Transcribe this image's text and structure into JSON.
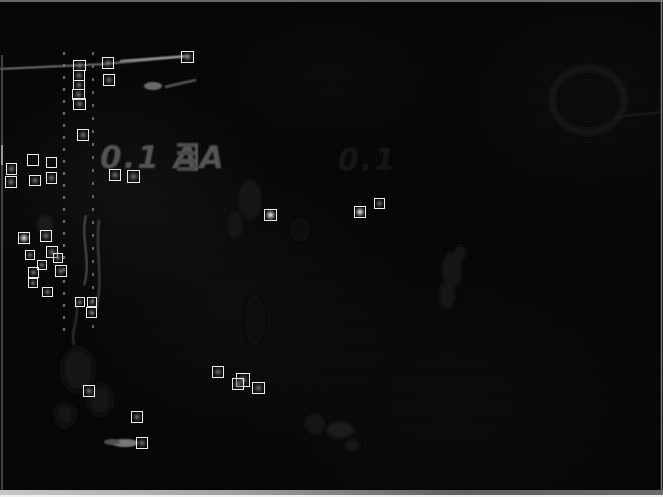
{
  "scene": {
    "description": "Dark grayscale processed night image (edge/difference map) of a vehicle-side scene with ladder poles, a cable line, faint truck marking and bushes",
    "background_color": "#050505",
    "marking_primary": "0.1 AA",
    "marking_secondary": "0.1",
    "frame": {
      "top_color": "#8a8a8a",
      "right_color": "#7a7a7a",
      "left_color": "#5a5a5a",
      "bottom_bar_left": "#c6c6c6",
      "bottom_bar_right": "#6a6a6a",
      "bottom_edge": "#f2f2f2"
    }
  },
  "overlay": {
    "box_color": "#eeeeee",
    "detections": [
      {
        "x": 73,
        "y": 60,
        "w": 13,
        "h": 11,
        "content": "dim"
      },
      {
        "x": 73,
        "y": 70,
        "w": 12,
        "h": 11,
        "content": "dim"
      },
      {
        "x": 73,
        "y": 80,
        "w": 12,
        "h": 10,
        "content": "dim"
      },
      {
        "x": 72,
        "y": 89,
        "w": 13,
        "h": 11,
        "content": "dim"
      },
      {
        "x": 73,
        "y": 98,
        "w": 13,
        "h": 12,
        "content": "dim"
      },
      {
        "x": 102,
        "y": 57,
        "w": 12,
        "h": 12,
        "content": "dim"
      },
      {
        "x": 103,
        "y": 74,
        "w": 12,
        "h": 12,
        "content": "dim"
      },
      {
        "x": 181,
        "y": 51,
        "w": 13,
        "h": 12,
        "content": "dim"
      },
      {
        "x": 77,
        "y": 129,
        "w": 12,
        "h": 12,
        "content": "dim"
      },
      {
        "x": 6,
        "y": 163,
        "w": 11,
        "h": 12,
        "content": "dim"
      },
      {
        "x": 5,
        "y": 176,
        "w": 12,
        "h": 12,
        "content": "dim"
      },
      {
        "x": 27,
        "y": 154,
        "w": 12,
        "h": 12,
        "content": "none"
      },
      {
        "x": 29,
        "y": 175,
        "w": 12,
        "h": 11,
        "content": "dim"
      },
      {
        "x": 46,
        "y": 157,
        "w": 11,
        "h": 11,
        "content": "none"
      },
      {
        "x": 46,
        "y": 172,
        "w": 11,
        "h": 12,
        "content": "dim"
      },
      {
        "x": 109,
        "y": 169,
        "w": 12,
        "h": 12,
        "content": "dim"
      },
      {
        "x": 127,
        "y": 170,
        "w": 13,
        "h": 13,
        "content": "dim"
      },
      {
        "x": 18,
        "y": 232,
        "w": 12,
        "h": 12,
        "content": "bright"
      },
      {
        "x": 40,
        "y": 230,
        "w": 12,
        "h": 12,
        "content": "dim"
      },
      {
        "x": 25,
        "y": 250,
        "w": 10,
        "h": 10,
        "content": "dim"
      },
      {
        "x": 46,
        "y": 246,
        "w": 12,
        "h": 12,
        "content": "dim"
      },
      {
        "x": 37,
        "y": 260,
        "w": 10,
        "h": 10,
        "content": "dim"
      },
      {
        "x": 53,
        "y": 253,
        "w": 10,
        "h": 10,
        "content": "dim"
      },
      {
        "x": 28,
        "y": 267,
        "w": 11,
        "h": 11,
        "content": "dim"
      },
      {
        "x": 55,
        "y": 265,
        "w": 12,
        "h": 12,
        "content": "dim"
      },
      {
        "x": 28,
        "y": 278,
        "w": 10,
        "h": 10,
        "content": "dim"
      },
      {
        "x": 42,
        "y": 287,
        "w": 11,
        "h": 10,
        "content": "dim"
      },
      {
        "x": 75,
        "y": 297,
        "w": 10,
        "h": 10,
        "content": "dim"
      },
      {
        "x": 87,
        "y": 297,
        "w": 10,
        "h": 10,
        "content": "dim"
      },
      {
        "x": 86,
        "y": 307,
        "w": 11,
        "h": 11,
        "content": "dim"
      },
      {
        "x": 264,
        "y": 209,
        "w": 13,
        "h": 12,
        "content": "bright"
      },
      {
        "x": 354,
        "y": 206,
        "w": 12,
        "h": 12,
        "content": "bright"
      },
      {
        "x": 374,
        "y": 198,
        "w": 11,
        "h": 11,
        "content": "dim"
      },
      {
        "x": 212,
        "y": 366,
        "w": 12,
        "h": 12,
        "content": "dim"
      },
      {
        "x": 236,
        "y": 373,
        "w": 14,
        "h": 14,
        "content": "dim"
      },
      {
        "x": 232,
        "y": 378,
        "w": 12,
        "h": 12,
        "content": "dim"
      },
      {
        "x": 252,
        "y": 382,
        "w": 13,
        "h": 12,
        "content": "dim"
      },
      {
        "x": 83,
        "y": 385,
        "w": 12,
        "h": 12,
        "content": "dim"
      },
      {
        "x": 131,
        "y": 411,
        "w": 12,
        "h": 12,
        "content": "dim"
      },
      {
        "x": 136,
        "y": 437,
        "w": 12,
        "h": 12,
        "content": "dim"
      }
    ]
  }
}
